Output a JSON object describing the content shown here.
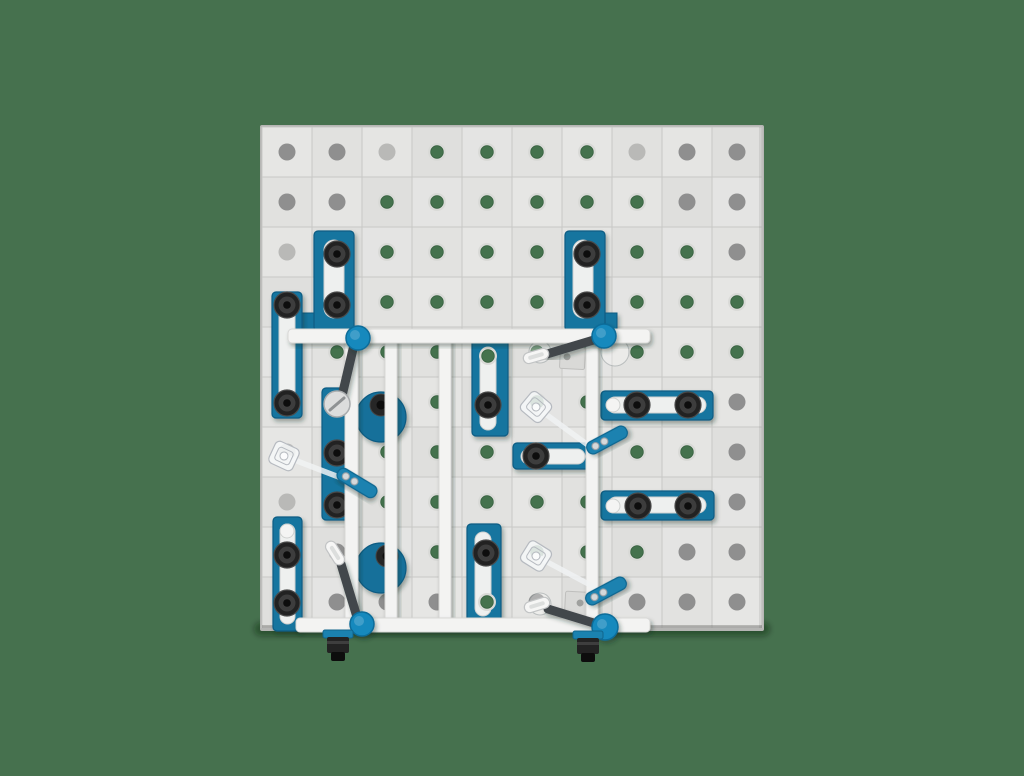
{
  "scene": {
    "width": 1024,
    "height": 776,
    "colors": {
      "background": "#46714E",
      "table_top": "#e3e3e2",
      "table_edge": "#b6b6b4",
      "grid_line": "#c6c6c4",
      "hole_gray": "#8f8f8f",
      "hole_light": "#b9b9b7",
      "hole_through": "#44724d",
      "hole_rim": "#d9dad7",
      "fixture_blue": "#15749f",
      "fixture_blue_dark": "#0c5c83",
      "fixture_blue_light": "#1b82b0",
      "slot_fill": "#eef0ef",
      "slot_edge": "#cfd1d0",
      "bolt_dark": "#202020",
      "bolt_mid": "#3c3c3c",
      "bolt_core": "#0a0a0a",
      "lever": "#42474c",
      "rail": "#f3f3f2",
      "rail_edge": "#d8d8d6",
      "knob": "#1489bd",
      "knob_dark": "#0b6c99",
      "washer": "#dcdddd",
      "washer_edge": "#a9acae",
      "pill": "#f6f6f5",
      "pill_edge": "#c2c4c5",
      "wrench": "#f0f2f3",
      "wrench_edge": "#b6bac0",
      "plate_gray": "#d9d9d7",
      "plate_edge": "#bfbfbd",
      "screw_silver": "#d5d8da"
    },
    "table": {
      "x": 262,
      "y": 127,
      "w": 500,
      "h": 501,
      "cols": 10,
      "rows": 10,
      "cell": 50,
      "hole_origin": [
        287,
        152
      ],
      "hole_pitch": 50,
      "hole_r": 8.5
    },
    "hole_matrix": [
      "ggGttttGgg",
      "ggttttttgg",
      "Gttttttttg",
      "tttttttttt",
      "Gttttttttt",
      "Gttttttttg",
      "Gttttttttg",
      "Gttttttttg",
      "ggttttttgg",
      "gggggggggg"
    ],
    "stops": [
      {
        "id": "stop-tall-left",
        "x": 314,
        "y": 231,
        "w": 40,
        "h": 100,
        "slot": [
          324,
          240,
          20,
          78
        ],
        "bolts": [
          [
            337,
            254
          ],
          [
            337,
            305
          ]
        ],
        "foot": [
          302,
          313,
          13,
          18
        ]
      },
      {
        "id": "stop-edge-left-upper",
        "x": 272,
        "y": 292,
        "w": 30,
        "h": 126,
        "slot": [
          279,
          300,
          16,
          110
        ],
        "bolts": [
          [
            287,
            305
          ],
          [
            287,
            403
          ]
        ]
      },
      {
        "id": "stop-tall-right",
        "x": 565,
        "y": 231,
        "w": 40,
        "h": 100,
        "slot": [
          573,
          240,
          20,
          78
        ],
        "bolts": [
          [
            587,
            254
          ],
          [
            587,
            305
          ]
        ],
        "foot": [
          604,
          313,
          13,
          18
        ]
      },
      {
        "id": "stop-center-upper",
        "x": 472,
        "y": 339,
        "w": 36,
        "h": 97,
        "slot": [
          480,
          347,
          16,
          83
        ],
        "bolts": [
          [
            488,
            405
          ]
        ],
        "slot_holes": [
          [
            488,
            356,
            "through"
          ]
        ]
      },
      {
        "id": "stop-edge-left-lower",
        "x": 273,
        "y": 517,
        "w": 29,
        "h": 114,
        "slot": [
          280,
          524,
          15,
          100
        ],
        "bolts": [
          [
            287,
            555
          ],
          [
            287,
            603
          ]
        ],
        "slot_holes": [
          [
            287,
            531,
            "empty"
          ]
        ]
      },
      {
        "id": "stop-center-lower",
        "x": 467,
        "y": 524,
        "w": 34,
        "h": 99,
        "slot": [
          475,
          532,
          16,
          84
        ],
        "bolts": [
          [
            486,
            553
          ]
        ],
        "slot_holes": [
          [
            487,
            602,
            "through"
          ]
        ]
      },
      {
        "id": "stop-horizontal-right-upper",
        "x": 601,
        "y": 391,
        "w": 112,
        "h": 29,
        "slot": [
          607,
          397,
          99,
          16
        ],
        "bolts": [
          [
            637,
            405
          ],
          [
            688,
            405
          ]
        ],
        "slot_holes": [
          [
            613,
            405,
            "empty"
          ]
        ]
      },
      {
        "id": "stop-horizontal-middle",
        "x": 513,
        "y": 443,
        "w": 77,
        "h": 26,
        "slot": [
          521,
          449,
          64,
          15
        ],
        "bolts": [
          [
            536,
            456
          ]
        ]
      },
      {
        "id": "stop-horizontal-right-lower",
        "x": 601,
        "y": 491,
        "w": 113,
        "h": 29,
        "slot": [
          608,
          497,
          98,
          16
        ],
        "bolts": [
          [
            638,
            506
          ],
          [
            688,
            506
          ]
        ],
        "slot_holes": [
          [
            613,
            506,
            "empty"
          ]
        ]
      },
      {
        "id": "rail-plate-left",
        "x": 322,
        "y": 388,
        "w": 26,
        "h": 132,
        "bolts": [
          [
            337,
            453
          ],
          [
            337,
            505
          ]
        ]
      }
    ],
    "disks": [
      {
        "cx": 381,
        "cy": 417,
        "r": 25,
        "bolt": [
          381,
          405
        ]
      },
      {
        "cx": 381,
        "cy": 568,
        "r": 25,
        "bolt": [
          387,
          556
        ]
      }
    ],
    "rails": {
      "verticals": [
        {
          "x": 345,
          "y": 334,
          "w": 13,
          "h": 292
        },
        {
          "x": 385,
          "y": 334,
          "w": 12,
          "h": 292
        },
        {
          "x": 439,
          "y": 334,
          "w": 12,
          "h": 292
        },
        {
          "x": 586,
          "y": 334,
          "w": 12,
          "h": 292
        }
      ],
      "horizontals": [
        {
          "x": 288,
          "y": 329,
          "w": 362,
          "h": 14
        },
        {
          "x": 296,
          "y": 618,
          "w": 354,
          "h": 14
        }
      ]
    },
    "wrenches": [
      {
        "head": [
          284,
          456
        ],
        "angle": 25,
        "tail": [
          344,
          479
        ]
      },
      {
        "head": [
          536,
          407
        ],
        "angle": 40,
        "tail": [
          592,
          448
        ]
      },
      {
        "head": [
          536,
          556
        ],
        "angle": 32,
        "tail": [
          594,
          587
        ]
      }
    ],
    "arms": [
      {
        "cx": 357,
        "cy": 483,
        "angle": 31
      },
      {
        "cx": 607,
        "cy": 440,
        "angle": -28
      },
      {
        "cx": 606,
        "cy": 591,
        "angle": -28
      }
    ],
    "clamps": [
      {
        "id": "toggle-clamp-top-left",
        "knob": [
          358,
          338
        ],
        "knob_r": 12,
        "lever": [
          354,
          345,
          341,
          400
        ],
        "grip": "washer",
        "grip_c": [
          337,
          404
        ],
        "grip_angle": 40
      },
      {
        "id": "toggle-clamp-top-right",
        "knob": [
          604,
          336
        ],
        "knob_r": 12,
        "lever": [
          597,
          339,
          547,
          354
        ],
        "grip": "pill",
        "grip_c": [
          536,
          356
        ],
        "grip_angle": -16
      },
      {
        "id": "toggle-clamp-bottom-left",
        "knob": [
          362,
          624
        ],
        "knob_r": 12,
        "lever": [
          357,
          617,
          341,
          564
        ],
        "grip": "pill",
        "grip_c": [
          335,
          553
        ],
        "grip_angle": 58
      },
      {
        "id": "toggle-clamp-bottom-right",
        "knob": [
          605,
          627
        ],
        "knob_r": 13,
        "lever": [
          597,
          624,
          548,
          609
        ],
        "grip": "pill",
        "grip_c": [
          537,
          605
        ],
        "grip_angle": -17
      }
    ],
    "plates": [
      {
        "x": 560,
        "y": 347,
        "w": 25,
        "h": 22,
        "angle": 3,
        "hole": [
          567,
          357
        ]
      },
      {
        "x": 565,
        "y": 592,
        "w": 32,
        "h": 25,
        "angle": 3,
        "hole": [
          580,
          603
        ]
      }
    ],
    "faint_washers": [
      [
        615,
        352,
        14
      ],
      [
        540,
        352,
        11
      ],
      [
        540,
        604,
        11
      ]
    ],
    "fittings": [
      {
        "x": 323,
        "y": 630
      },
      {
        "x": 573,
        "y": 631
      }
    ]
  }
}
